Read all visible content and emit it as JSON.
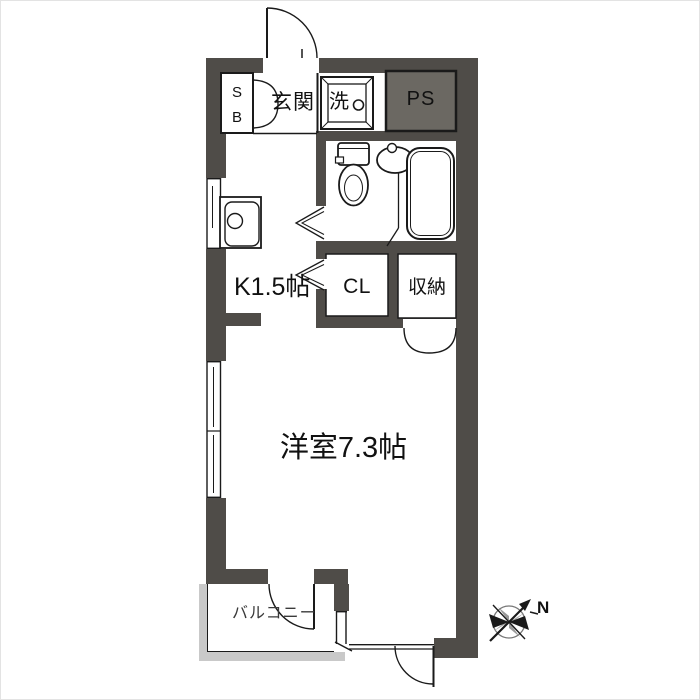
{
  "title": "apartment-floor-plan",
  "labels": {
    "sb_top": "S",
    "sb_bottom": "B",
    "genkan": "玄関",
    "washer": "洗",
    "ps": "PS",
    "kitchen": "K1.5帖",
    "closet": "CL",
    "storage": "収納",
    "main_room": "洋室7.3帖",
    "balcony": "バルコニー",
    "compass_north": "N"
  },
  "colors": {
    "wall": "#4f4c48",
    "ps_fill": "#6b6862",
    "line": "#1a1a1a",
    "balcony_rail": "#c9c9c9",
    "background": "#ffffff",
    "text": "#111111"
  }
}
